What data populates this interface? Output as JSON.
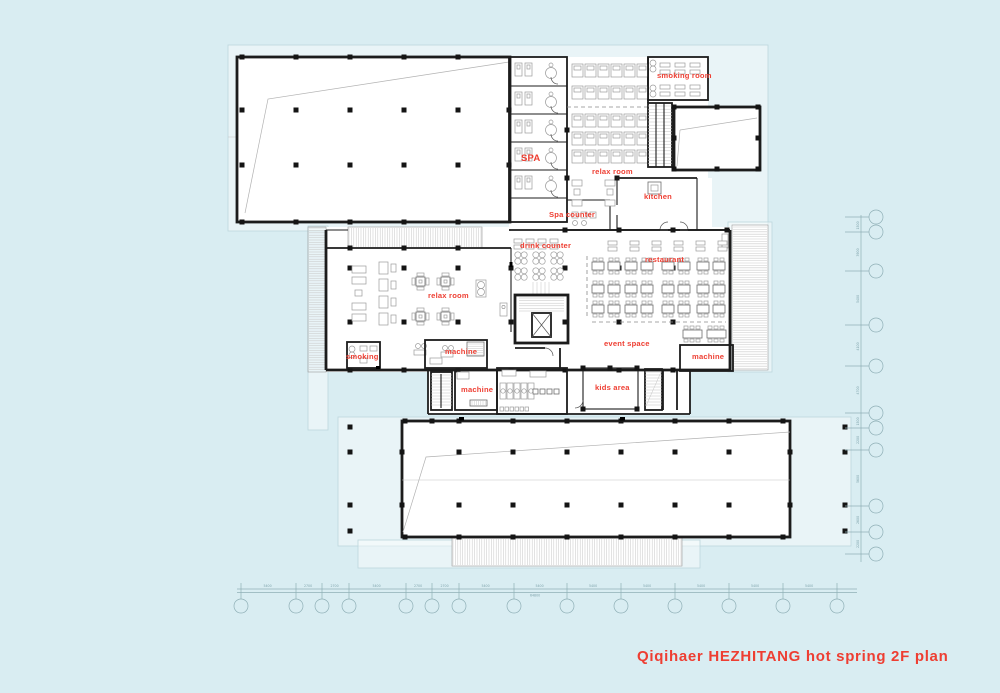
{
  "title": "Qiqihaer HEZHITANG hot spring 2F plan",
  "colors": {
    "background": "#d9edf2",
    "accent_red": "#ee3e32",
    "wall": "#1c1c1c"
  },
  "room_labels": {
    "spa": "SPA",
    "smoking_room_top": "smoking room",
    "relax_room_top": "relax room",
    "kitchen": "kitchen",
    "spa_counter": "Spa counter",
    "drink_counter": "drink counter",
    "restaurant": "restaurant",
    "relax_room_mid": "relax room",
    "event_space": "event space",
    "machine_right": "machine",
    "smoking_mid": "smoking",
    "machine_upper": "machine",
    "machine_lower": "machine",
    "kids_area": "kids area"
  },
  "dimensions": {
    "bottom": {
      "values": [
        "5400",
        "2700",
        "2700",
        "5400",
        "2700",
        "2700",
        "5400",
        "5400",
        "5400",
        "5400",
        "5400",
        "5400",
        "5400"
      ],
      "total": "64800"
    },
    "right": {
      "values": [
        "1500",
        "3900",
        "5400",
        "4100",
        "4700",
        "1500",
        "2200",
        "5600",
        "2600",
        "2200"
      ]
    }
  }
}
